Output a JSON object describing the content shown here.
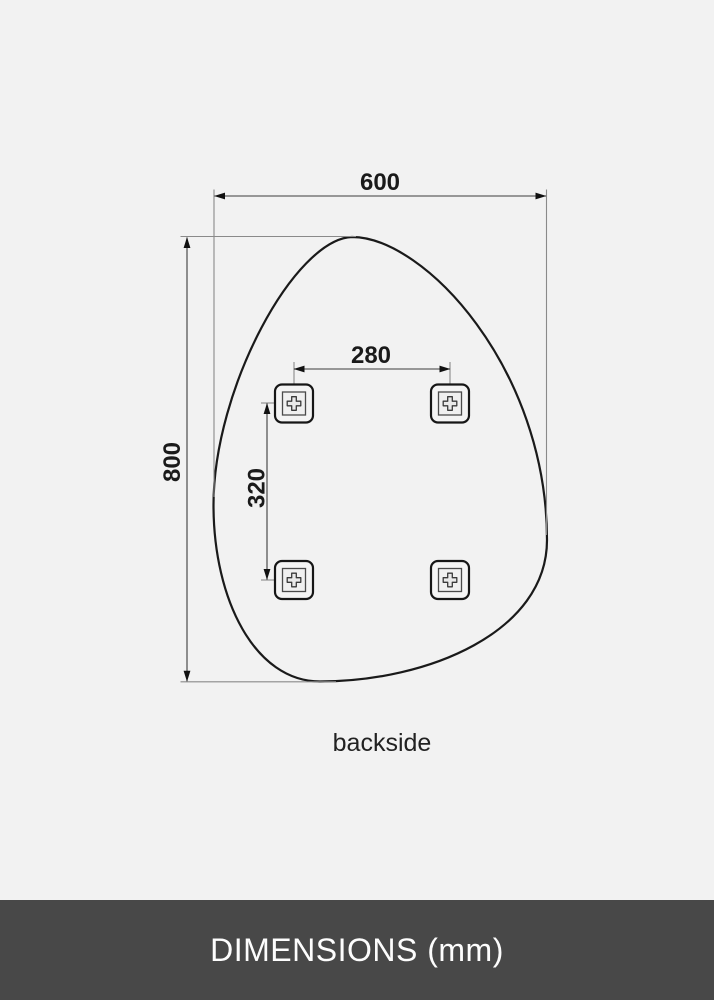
{
  "diagram": {
    "width_label": "600",
    "height_label": "800",
    "hole_spacing_horizontal_label": "280",
    "hole_spacing_vertical_label": "320",
    "caption": "backside"
  },
  "footer": {
    "title": "DIMENSIONS (mm)"
  },
  "colors": {
    "background": "#f2f2f2",
    "mirror_outline": "#1a1a1a",
    "dimension_line": "#555555",
    "extension_line": "#8a8a8a",
    "arrow": "#111111",
    "footer_background": "#484848",
    "footer_text": "#fdfdfd"
  }
}
